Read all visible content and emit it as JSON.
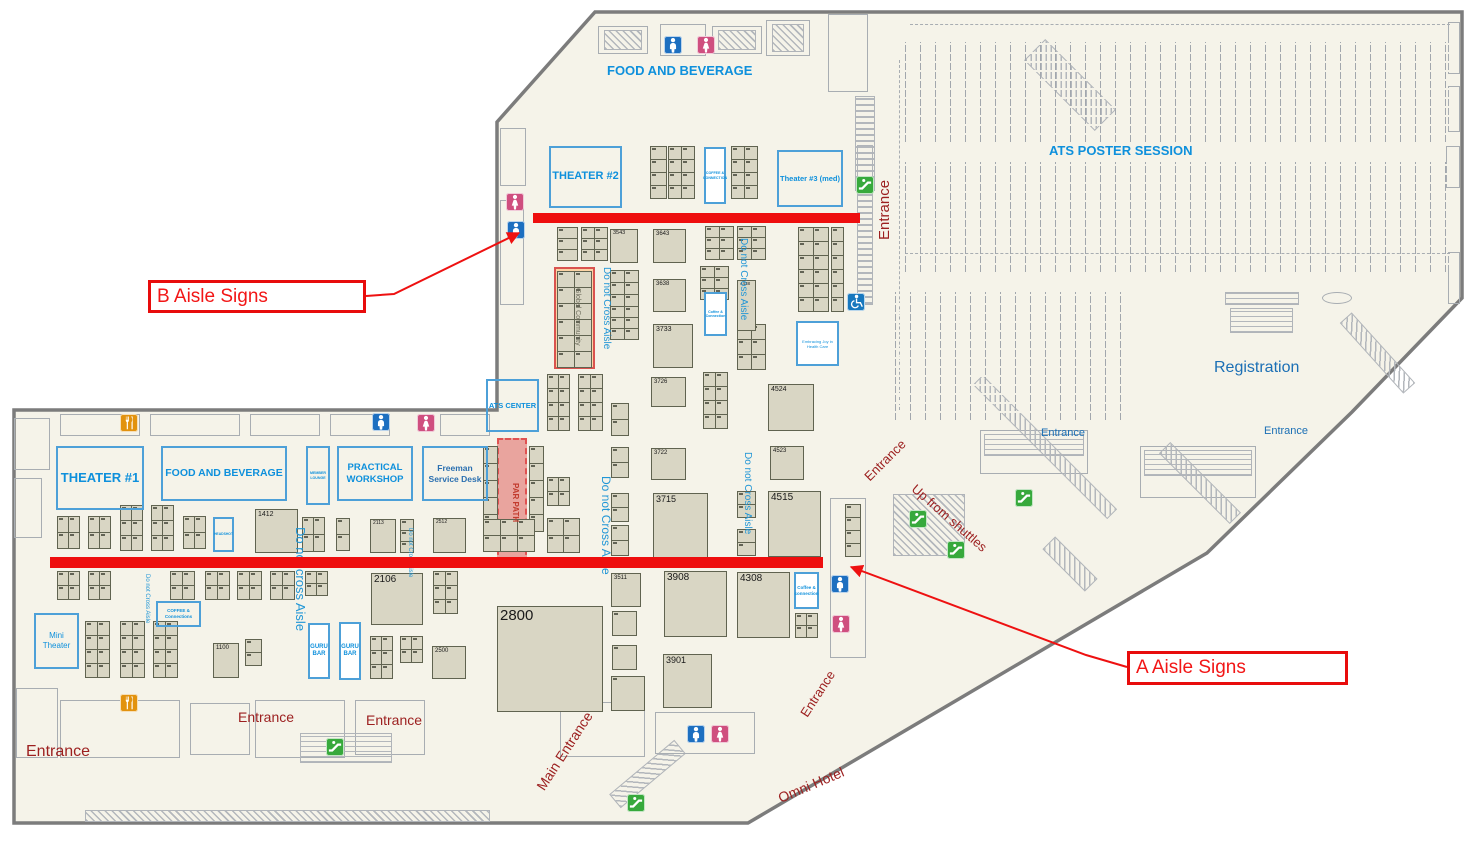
{
  "title": "Exhibit hall floor plan with aisle sign annotations",
  "colors": {
    "floor": "#f5f3e9",
    "wall": "#7c7c7c",
    "boothFill": "#d9d6c4",
    "boothBorder": "#606350",
    "blue": "#0e90dc",
    "medblue": "#1b6fb5",
    "aisle": "#2196d6",
    "darkred": "#9c1f1f",
    "red": "#ee1111",
    "zoneBorder": "#4da0d8",
    "structure": "#a8adb2",
    "orangeBand": "#fbd3a4",
    "orangeBandBorder": "#d9534f",
    "parBand": "#e9a49e",
    "parBandBorder": "#e05252",
    "man": "#1d6fc0",
    "woman": "#cf4f7f",
    "esc": "#37a93c",
    "wheel": "#1878be",
    "food": "#e2920e"
  },
  "outline": "595,12 1462,12 1462,298 1352,412 1207,553 748,823 14,823 14,410 497,410 497,122",
  "callouts": [
    {
      "t": "B Aisle Signs",
      "x": 148,
      "y": 280,
      "w": 218,
      "h": 33,
      "s": 19,
      "leader": [
        [
          366,
          296
        ],
        [
          394,
          294
        ],
        [
          519,
          233
        ]
      ]
    },
    {
      "t": "A Aisle Signs",
      "x": 1127,
      "y": 651,
      "w": 221,
      "h": 34,
      "s": 19,
      "leader": [
        [
          1127,
          667
        ],
        [
          1086,
          655
        ],
        [
          851,
          567
        ]
      ]
    }
  ],
  "aisle_lines": [
    {
      "name": "b-aisle-line",
      "x": 533,
      "y": 213,
      "w": 327,
      "h": 10
    },
    {
      "name": "a-aisle-line",
      "x": 50,
      "y": 557,
      "w": 773,
      "h": 11
    }
  ],
  "labels": [
    {
      "t": "FOOD AND BEVERAGE",
      "x": 607,
      "y": 64,
      "s": 13,
      "c": "blue",
      "b": 1
    },
    {
      "t": "ATS POSTER SESSION",
      "x": 1049,
      "y": 144,
      "s": 13,
      "c": "blue",
      "b": 1
    },
    {
      "t": "Registration",
      "x": 1214,
      "y": 360,
      "s": 16,
      "c": "medblue"
    },
    {
      "t": "Entrance",
      "x": 1041,
      "y": 428,
      "s": 11,
      "c": "medblue"
    },
    {
      "t": "Entrance",
      "x": 1264,
      "y": 426,
      "s": 11,
      "c": "medblue"
    },
    {
      "t": "Entrance",
      "x": 877,
      "y": 240,
      "s": 15,
      "c": "darkred",
      "r": -90
    },
    {
      "t": "Entrance",
      "x": 862,
      "y": 474,
      "s": 13,
      "c": "darkred",
      "r": -45
    },
    {
      "t": "Up from shuttles",
      "x": 918,
      "y": 482,
      "s": 13,
      "c": "darkred",
      "r": 41
    },
    {
      "t": "Main Entrance",
      "x": 534,
      "y": 785,
      "s": 14,
      "c": "darkred",
      "r": -57
    },
    {
      "t": "Entrance",
      "x": 798,
      "y": 712,
      "s": 13,
      "c": "darkred",
      "r": -57
    },
    {
      "t": "Omni Hotel",
      "x": 776,
      "y": 792,
      "s": 14,
      "c": "darkred",
      "r": -23
    },
    {
      "t": "Entrance",
      "x": 26,
      "y": 744,
      "s": 16,
      "c": "darkred"
    },
    {
      "t": "Entrance",
      "x": 238,
      "y": 710,
      "s": 14,
      "c": "darkred"
    },
    {
      "t": "Entrance",
      "x": 366,
      "y": 713,
      "s": 14,
      "c": "darkred"
    },
    {
      "t": "Do not Cross Aisle",
      "x": 611,
      "y": 267,
      "s": 10,
      "c": "aisle",
      "r": 90
    },
    {
      "t": "Do not Cross Aisle",
      "x": 748,
      "y": 238,
      "s": 10,
      "c": "aisle",
      "r": 90
    },
    {
      "t": "Do not Cross Aisle",
      "x": 612,
      "y": 476,
      "s": 12,
      "c": "aisle",
      "r": 90
    },
    {
      "t": "Do not Cross Aisle",
      "x": 752,
      "y": 452,
      "s": 10,
      "c": "aisle",
      "r": 90
    },
    {
      "t": "Do not cross Aisle",
      "x": 307,
      "y": 527,
      "s": 13,
      "c": "aisle",
      "r": 90
    },
    {
      "t": "Do not Cross Aisle",
      "x": 150,
      "y": 574,
      "s": 6,
      "c": "aisle",
      "r": 90
    },
    {
      "t": "Do not Cross Aisle",
      "x": 413,
      "y": 528,
      "s": 6,
      "c": "aisle",
      "r": 90
    },
    {
      "t": "Global Community",
      "x": 581,
      "y": 288,
      "s": 7,
      "c": "#6b6b5a",
      "r": 90
    },
    {
      "t": "PAR PATH",
      "x": 519,
      "y": 483,
      "s": 8,
      "c": "#c23b2e",
      "r": 90,
      "b": 1
    }
  ],
  "zones": [
    {
      "t": "THEATER #2",
      "x": 549,
      "y": 146,
      "w": 73,
      "h": 62,
      "s": 11
    },
    {
      "t": "Theater #3 (med)",
      "x": 777,
      "y": 150,
      "w": 66,
      "h": 57,
      "s": 7.5
    },
    {
      "t": "COFFEE & CONNECTION",
      "x": 704,
      "y": 147,
      "w": 22,
      "h": 57,
      "s": 3.6,
      "white": 1
    },
    {
      "t": "ATS CENTER",
      "x": 486,
      "y": 379,
      "w": 53,
      "h": 53,
      "s": 7.5
    },
    {
      "t": "THEATER #1",
      "x": 56,
      "y": 446,
      "w": 88,
      "h": 64,
      "s": 13
    },
    {
      "t": "FOOD AND BEVERAGE",
      "x": 161,
      "y": 446,
      "w": 126,
      "h": 55,
      "s": 10.5
    },
    {
      "t": "MEMBER LOUNGE",
      "x": 306,
      "y": 446,
      "w": 24,
      "h": 59,
      "s": 3.6
    },
    {
      "t": "PRACTICAL WORKSHOP",
      "x": 337,
      "y": 446,
      "w": 76,
      "h": 55,
      "s": 9.5
    },
    {
      "t": "Freeman Service Desk",
      "x": 422,
      "y": 446,
      "w": 66,
      "h": 55,
      "s": 8.5,
      "c": "#2a6fb0"
    },
    {
      "t": "Mini Theater",
      "x": 34,
      "y": 613,
      "w": 45,
      "h": 56,
      "s": 8,
      "b": 0
    },
    {
      "t": "GURU BAR",
      "x": 308,
      "y": 623,
      "w": 22,
      "h": 56,
      "s": 6,
      "white": 1
    },
    {
      "t": "GURU BAR",
      "x": 339,
      "y": 622,
      "w": 22,
      "h": 58,
      "s": 6,
      "white": 1
    },
    {
      "t": "COFFEE & Connections",
      "x": 156,
      "y": 601,
      "w": 45,
      "h": 26,
      "s": 4.5
    },
    {
      "t": "Coffee & connection",
      "x": 794,
      "y": 572,
      "w": 25,
      "h": 37,
      "s": 4.5,
      "white": 1
    },
    {
      "t": "Coffee & Connection",
      "x": 704,
      "y": 292,
      "w": 23,
      "h": 44,
      "s": 3.6,
      "white": 1
    },
    {
      "t": "Embracing Joy in Health Care",
      "x": 796,
      "y": 321,
      "w": 43,
      "h": 45,
      "s": 4,
      "white": 1,
      "b": 0
    },
    {
      "t": "HEADSHOT",
      "x": 213,
      "y": 517,
      "w": 21,
      "h": 35,
      "s": 3.4
    }
  ],
  "booths": [
    {
      "n": "1412",
      "x": 255,
      "y": 509,
      "w": 43,
      "h": 44,
      "s": 7
    },
    {
      "n": "2106",
      "x": 371,
      "y": 573,
      "w": 52,
      "h": 52,
      "s": 10
    },
    {
      "n": "2800",
      "x": 497,
      "y": 606,
      "w": 106,
      "h": 106,
      "s": 15
    },
    {
      "n": "3511",
      "x": 611,
      "y": 573,
      "w": 30,
      "h": 34,
      "s": 6
    },
    {
      "n": "3908",
      "x": 664,
      "y": 571,
      "w": 63,
      "h": 66,
      "s": 10
    },
    {
      "n": "4308",
      "x": 737,
      "y": 572,
      "w": 53,
      "h": 66,
      "s": 10
    },
    {
      "n": "3901",
      "x": 663,
      "y": 654,
      "w": 49,
      "h": 54,
      "s": 9
    },
    {
      "n": "3715",
      "x": 653,
      "y": 493,
      "w": 55,
      "h": 65,
      "s": 9
    },
    {
      "n": "4515",
      "x": 768,
      "y": 491,
      "w": 53,
      "h": 66,
      "s": 10
    },
    {
      "n": "4524",
      "x": 768,
      "y": 384,
      "w": 46,
      "h": 47,
      "s": 7
    },
    {
      "n": "4523",
      "x": 770,
      "y": 446,
      "w": 34,
      "h": 34,
      "s": 6
    },
    {
      "n": "3733",
      "x": 653,
      "y": 324,
      "w": 40,
      "h": 44,
      "s": 7
    },
    {
      "n": "3643",
      "x": 653,
      "y": 229,
      "w": 33,
      "h": 34,
      "s": 6
    },
    {
      "n": "3638",
      "x": 653,
      "y": 279,
      "w": 33,
      "h": 33,
      "s": 6
    },
    {
      "n": "3543",
      "x": 610,
      "y": 229,
      "w": 28,
      "h": 34,
      "s": 5.5
    },
    {
      "n": "3726",
      "x": 651,
      "y": 377,
      "w": 35,
      "h": 30,
      "s": 6
    },
    {
      "n": "3722",
      "x": 651,
      "y": 448,
      "w": 35,
      "h": 32,
      "s": 6
    },
    {
      "n": "4438",
      "x": 737,
      "y": 280,
      "w": 19,
      "h": 51,
      "s": 4.5
    },
    {
      "n": "1100",
      "x": 213,
      "y": 643,
      "w": 26,
      "h": 35,
      "s": 6
    },
    {
      "n": "2500",
      "x": 432,
      "y": 646,
      "w": 34,
      "h": 33,
      "s": 6
    },
    {
      "n": "2113",
      "x": 370,
      "y": 519,
      "w": 26,
      "h": 34,
      "s": 5
    },
    {
      "n": "2512",
      "x": 433,
      "y": 518,
      "w": 33,
      "h": 35,
      "s": 5
    }
  ],
  "clusters": [
    [
      557,
      227,
      1,
      3,
      20,
      11
    ],
    [
      581,
      227,
      2,
      3,
      13,
      11
    ],
    [
      705,
      226,
      2,
      3,
      14,
      11
    ],
    [
      737,
      226,
      2,
      3,
      14,
      11
    ],
    [
      798,
      227,
      2,
      6,
      15,
      14
    ],
    [
      831,
      227,
      1,
      6,
      12,
      14
    ],
    [
      610,
      270,
      2,
      3,
      14,
      12
    ],
    [
      610,
      306,
      2,
      3,
      14,
      11
    ],
    [
      700,
      266,
      2,
      3,
      14,
      11
    ],
    [
      737,
      324,
      2,
      3,
      14,
      15
    ],
    [
      557,
      271,
      2,
      6,
      17,
      16
    ],
    [
      650,
      146,
      1,
      4,
      16,
      13
    ],
    [
      668,
      146,
      2,
      4,
      13,
      13
    ],
    [
      731,
      146,
      2,
      4,
      13,
      13
    ],
    [
      547,
      374,
      2,
      4,
      11,
      14
    ],
    [
      578,
      374,
      2,
      4,
      12,
      14
    ],
    [
      611,
      403,
      1,
      2,
      17,
      16
    ],
    [
      611,
      447,
      1,
      2,
      17,
      15
    ],
    [
      611,
      493,
      1,
      2,
      17,
      14
    ],
    [
      611,
      525,
      1,
      2,
      17,
      15
    ],
    [
      703,
      372,
      2,
      4,
      12,
      14
    ],
    [
      737,
      491,
      1,
      2,
      18,
      13
    ],
    [
      737,
      529,
      1,
      2,
      18,
      13
    ],
    [
      483,
      446,
      1,
      5,
      14,
      17
    ],
    [
      529,
      446,
      1,
      5,
      14,
      17
    ],
    [
      483,
      519,
      3,
      2,
      17,
      16
    ],
    [
      547,
      477,
      2,
      2,
      11,
      14
    ],
    [
      547,
      518,
      2,
      2,
      16,
      17
    ],
    [
      57,
      516,
      2,
      2,
      11,
      16
    ],
    [
      88,
      516,
      2,
      2,
      11,
      16
    ],
    [
      120,
      505,
      2,
      3,
      11,
      15
    ],
    [
      151,
      505,
      2,
      3,
      11,
      15
    ],
    [
      183,
      516,
      2,
      2,
      11,
      16
    ],
    [
      302,
      517,
      2,
      2,
      11,
      17
    ],
    [
      336,
      518,
      1,
      2,
      13,
      16
    ],
    [
      400,
      519,
      1,
      3,
      13,
      11
    ],
    [
      57,
      571,
      2,
      2,
      11,
      14
    ],
    [
      88,
      571,
      2,
      2,
      11,
      14
    ],
    [
      170,
      571,
      2,
      2,
      12,
      14
    ],
    [
      205,
      571,
      2,
      2,
      12,
      14
    ],
    [
      237,
      571,
      2,
      2,
      12,
      14
    ],
    [
      270,
      571,
      2,
      2,
      12,
      14
    ],
    [
      305,
      571,
      2,
      2,
      11,
      12
    ],
    [
      85,
      621,
      2,
      4,
      12,
      14
    ],
    [
      120,
      621,
      2,
      4,
      12,
      14
    ],
    [
      153,
      621,
      2,
      4,
      12,
      14
    ],
    [
      245,
      639,
      1,
      2,
      16,
      13
    ],
    [
      370,
      636,
      2,
      3,
      11,
      14
    ],
    [
      400,
      636,
      2,
      2,
      11,
      13
    ],
    [
      433,
      571,
      2,
      3,
      12,
      14
    ],
    [
      612,
      611,
      1,
      1,
      24,
      24
    ],
    [
      612,
      645,
      1,
      1,
      24,
      24
    ],
    [
      611,
      676,
      1,
      1,
      33,
      34
    ],
    [
      795,
      613,
      2,
      2,
      11,
      12
    ],
    [
      845,
      504,
      1,
      4,
      15,
      13
    ]
  ],
  "special": {
    "orange_band": {
      "x": 554,
      "y": 267,
      "w": 41,
      "h": 102
    },
    "par_path": {
      "x": 497,
      "y": 438,
      "w": 30,
      "h": 127
    }
  },
  "poster_bands": [
    [
      905,
      42,
      545,
      100
    ],
    [
      905,
      162,
      545,
      110
    ],
    [
      895,
      292,
      240,
      128
    ]
  ],
  "icons": [
    {
      "k": "man",
      "x": 664,
      "y": 36
    },
    {
      "k": "woman",
      "x": 697,
      "y": 36
    },
    {
      "k": "woman",
      "x": 506,
      "y": 193
    },
    {
      "k": "man",
      "x": 507,
      "y": 221
    },
    {
      "k": "esc",
      "x": 856,
      "y": 176
    },
    {
      "k": "wheel",
      "x": 847,
      "y": 293
    },
    {
      "k": "food",
      "x": 120,
      "y": 414
    },
    {
      "k": "man",
      "x": 372,
      "y": 413
    },
    {
      "k": "woman",
      "x": 417,
      "y": 414
    },
    {
      "k": "esc",
      "x": 1015,
      "y": 489
    },
    {
      "k": "esc",
      "x": 909,
      "y": 510
    },
    {
      "k": "esc",
      "x": 947,
      "y": 541
    },
    {
      "k": "man",
      "x": 831,
      "y": 575
    },
    {
      "k": "woman",
      "x": 832,
      "y": 615
    },
    {
      "k": "food",
      "x": 120,
      "y": 694
    },
    {
      "k": "esc",
      "x": 326,
      "y": 738
    },
    {
      "k": "man",
      "x": 687,
      "y": 725
    },
    {
      "k": "woman",
      "x": 711,
      "y": 725
    },
    {
      "k": "esc",
      "x": 627,
      "y": 794
    }
  ],
  "deco": [
    {
      "k": "out",
      "x": 598,
      "y": 26,
      "w": 50,
      "h": 28
    },
    {
      "k": "hatch",
      "x": 604,
      "y": 30,
      "w": 38,
      "h": 20
    },
    {
      "k": "out",
      "x": 660,
      "y": 24,
      "w": 46,
      "h": 32
    },
    {
      "k": "out",
      "x": 712,
      "y": 26,
      "w": 50,
      "h": 28
    },
    {
      "k": "hatch",
      "x": 718,
      "y": 30,
      "w": 38,
      "h": 20
    },
    {
      "k": "out",
      "x": 766,
      "y": 20,
      "w": 44,
      "h": 36
    },
    {
      "k": "hatch",
      "x": 772,
      "y": 24,
      "w": 32,
      "h": 28
    },
    {
      "k": "out",
      "x": 828,
      "y": 14,
      "w": 40,
      "h": 78
    },
    {
      "k": "hatchv",
      "x": 855,
      "y": 96,
      "w": 20,
      "h": 95
    },
    {
      "k": "hatch",
      "x": 1020,
      "y": 70,
      "w": 100,
      "h": 30,
      "rot": 45
    },
    {
      "k": "dashh",
      "x": 910,
      "y": 24,
      "w": 540
    },
    {
      "k": "out",
      "x": 1448,
      "y": 22,
      "w": 12,
      "h": 52
    },
    {
      "k": "out",
      "x": 1448,
      "y": 86,
      "w": 12,
      "h": 46
    },
    {
      "k": "out",
      "x": 1446,
      "y": 146,
      "w": 14,
      "h": 42
    },
    {
      "k": "out",
      "x": 1448,
      "y": 252,
      "w": 12,
      "h": 52
    },
    {
      "k": "dashv",
      "x": 899,
      "y": 60,
      "h": 350
    },
    {
      "k": "hatchv",
      "x": 857,
      "y": 145,
      "w": 16,
      "h": 160
    },
    {
      "k": "out",
      "x": 500,
      "y": 128,
      "w": 26,
      "h": 58
    },
    {
      "k": "out",
      "x": 500,
      "y": 200,
      "w": 24,
      "h": 105
    },
    {
      "k": "out",
      "x": 60,
      "y": 414,
      "w": 80,
      "h": 22
    },
    {
      "k": "out",
      "x": 150,
      "y": 414,
      "w": 90,
      "h": 22
    },
    {
      "k": "out",
      "x": 250,
      "y": 414,
      "w": 70,
      "h": 22
    },
    {
      "k": "out",
      "x": 330,
      "y": 414,
      "w": 60,
      "h": 22
    },
    {
      "k": "out",
      "x": 440,
      "y": 414,
      "w": 50,
      "h": 22
    },
    {
      "k": "out",
      "x": 60,
      "y": 700,
      "w": 120,
      "h": 58
    },
    {
      "k": "out",
      "x": 190,
      "y": 703,
      "w": 60,
      "h": 52
    },
    {
      "k": "out",
      "x": 255,
      "y": 700,
      "w": 90,
      "h": 58
    },
    {
      "k": "out",
      "x": 355,
      "y": 700,
      "w": 70,
      "h": 55
    },
    {
      "k": "grid",
      "x": 300,
      "y": 733,
      "w": 92,
      "h": 30
    },
    {
      "k": "out",
      "x": 560,
      "y": 702,
      "w": 85,
      "h": 55
    },
    {
      "k": "hatch",
      "x": 605,
      "y": 765,
      "w": 85,
      "h": 18,
      "rot": -40
    },
    {
      "k": "hatch",
      "x": 85,
      "y": 810,
      "w": 405,
      "h": 12
    },
    {
      "k": "out",
      "x": 14,
      "y": 418,
      "w": 36,
      "h": 52
    },
    {
      "k": "out",
      "x": 14,
      "y": 478,
      "w": 28,
      "h": 60
    },
    {
      "k": "out",
      "x": 16,
      "y": 688,
      "w": 42,
      "h": 70
    },
    {
      "k": "out",
      "x": 655,
      "y": 712,
      "w": 100,
      "h": 42
    },
    {
      "k": "out",
      "x": 830,
      "y": 498,
      "w": 36,
      "h": 160
    },
    {
      "k": "hatch",
      "x": 893,
      "y": 494,
      "w": 72,
      "h": 62
    },
    {
      "k": "out",
      "x": 980,
      "y": 430,
      "w": 108,
      "h": 44
    },
    {
      "k": "grid",
      "x": 984,
      "y": 434,
      "w": 100,
      "h": 22
    },
    {
      "k": "out",
      "x": 1140,
      "y": 446,
      "w": 116,
      "h": 52
    },
    {
      "k": "grid",
      "x": 1144,
      "y": 450,
      "w": 108,
      "h": 26
    },
    {
      "k": "hatch",
      "x": 1150,
      "y": 475,
      "w": 100,
      "h": 16,
      "rot": 45
    },
    {
      "k": "hatch",
      "x": 1040,
      "y": 555,
      "w": 60,
      "h": 18,
      "rot": 45
    },
    {
      "k": "hatch",
      "x": 950,
      "y": 440,
      "w": 190,
      "h": 14,
      "rot": 45
    },
    {
      "k": "grid",
      "x": 1225,
      "y": 292,
      "w": 74,
      "h": 13
    },
    {
      "k": "oval",
      "x": 1322,
      "y": 292,
      "w": 30,
      "h": 12
    },
    {
      "k": "grid",
      "x": 1230,
      "y": 308,
      "w": 63,
      "h": 25
    },
    {
      "k": "hatch",
      "x": 1330,
      "y": 345,
      "w": 95,
      "h": 16,
      "rot": 48
    },
    {
      "k": "dashh",
      "x": 905,
      "y": 253,
      "w": 545
    }
  ]
}
